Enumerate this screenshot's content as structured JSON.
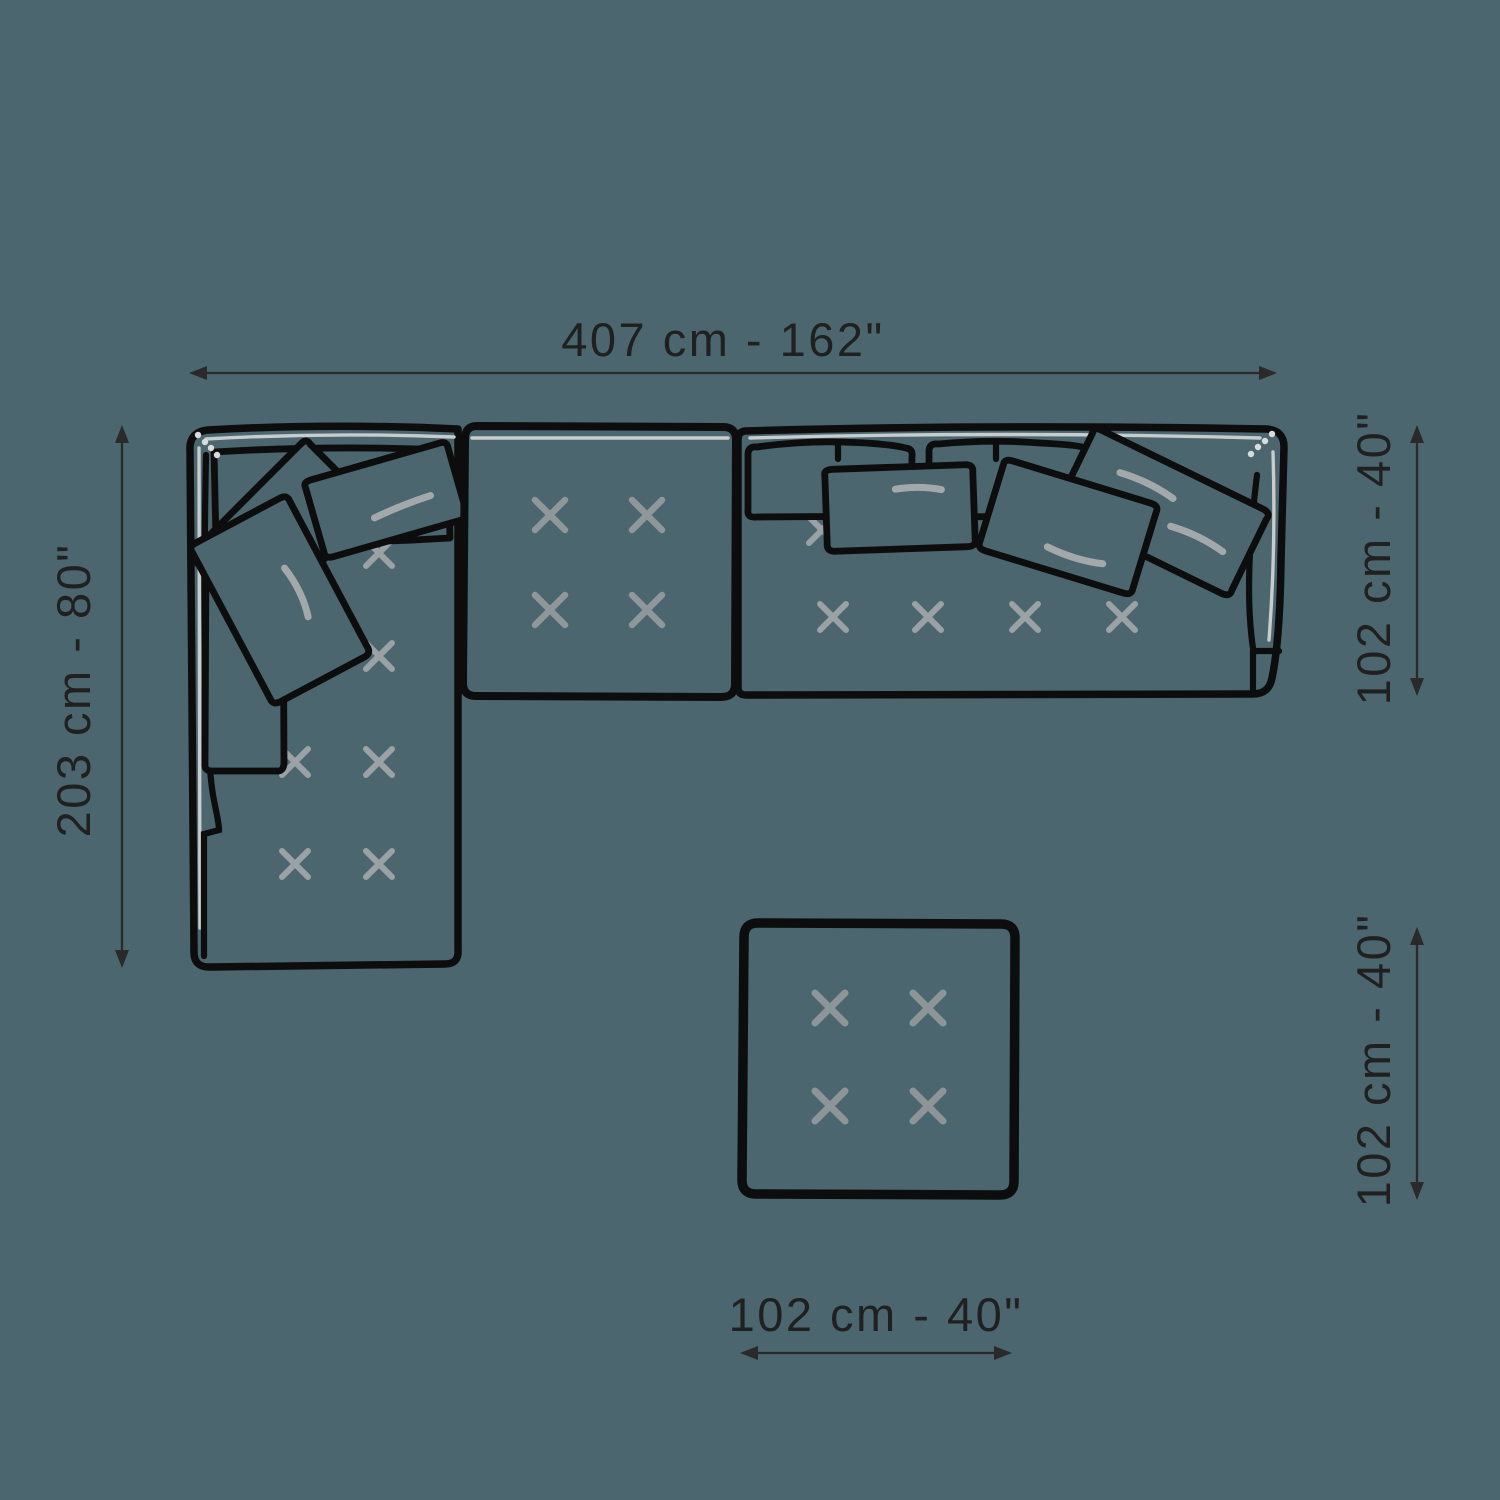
{
  "diagram": {
    "background_color": "#4b666e",
    "outline_color": "#0d0d0d",
    "stitch_x_color": "#939a9e",
    "highlight_color": "#c7cccd",
    "dimension_color": "#202020",
    "parts": [
      "chaise-module",
      "center-seat-module",
      "right-seat-module",
      "back-cushions",
      "throw-pillows",
      "ottoman"
    ],
    "dimensions": {
      "sofa_total_width": "407 cm - 162\"",
      "sofa_total_depth": "203 cm - 80\"",
      "right_section_depth": "102 cm - 40\"",
      "ottoman_depth": "102 cm - 40\"",
      "ottoman_width": "102 cm - 40\""
    }
  }
}
